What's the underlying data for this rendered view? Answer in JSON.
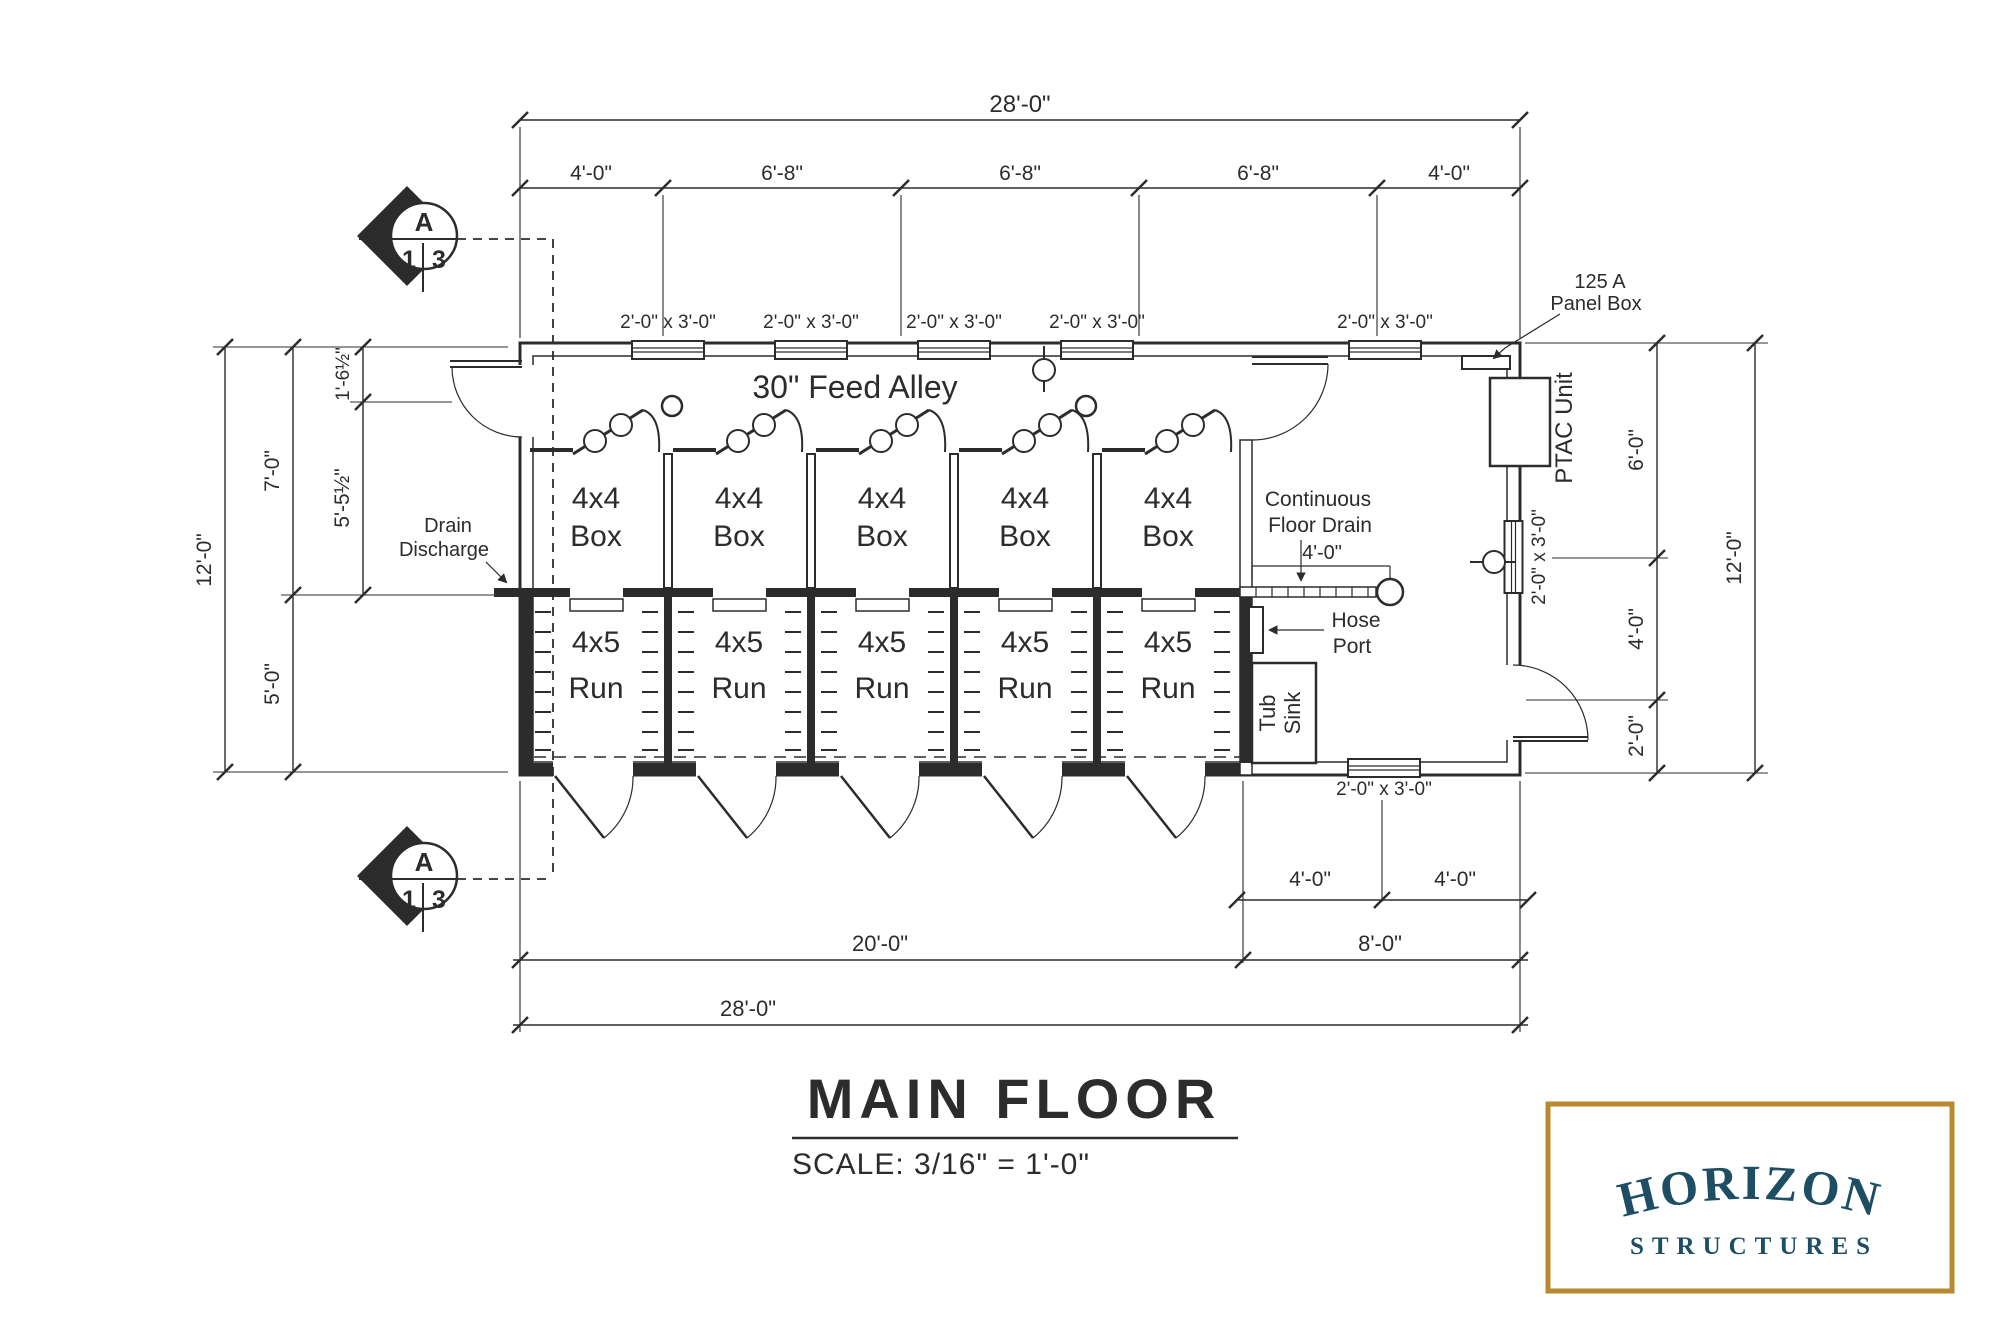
{
  "drawing": {
    "feed_alley": "30\" Feed Alley",
    "stalls": [
      {
        "box1": "4x4",
        "box2": "Box",
        "run1": "4x5",
        "run2": "Run"
      },
      {
        "box1": "4x4",
        "box2": "Box",
        "run1": "4x5",
        "run2": "Run"
      },
      {
        "box1": "4x4",
        "box2": "Box",
        "run1": "4x5",
        "run2": "Run"
      },
      {
        "box1": "4x4",
        "box2": "Box",
        "run1": "4x5",
        "run2": "Run"
      },
      {
        "box1": "4x4",
        "box2": "Box",
        "run1": "4x5",
        "run2": "Run"
      }
    ],
    "annotations": {
      "panel1": "125 A",
      "panel2": "Panel Box",
      "cfd1": "Continuous",
      "cfd2": "Floor Drain",
      "cfd_dim": "4'-0\"",
      "drain1": "Drain",
      "drain2": "Discharge",
      "hose1": "Hose",
      "hose2": "Port",
      "tub1": "Tub",
      "tub2": "Sink",
      "ptac": "PTAC Unit"
    },
    "dims": {
      "window_size": "2'-0\" x 3'-0\"",
      "top_overall": "28'-0\"",
      "top_segments": [
        "4'-0\"",
        "6'-8\"",
        "6'-8\"",
        "6'-8\"",
        "4'-0\""
      ],
      "left_overall": "12'-0\"",
      "left_upper": "7'-0\"",
      "left_lower": "5'-0\"",
      "left_inner_upper": "1'-6½\"",
      "left_inner_lower": "5'-5½\"",
      "right_overall": "12'-0\"",
      "right_a": "6'-0\"",
      "right_b": "4'-0\"",
      "right_c": "2'-0\"",
      "bottom_left": "20'-0\"",
      "bottom_right": "8'-0\"",
      "bottom_overall": "28'-0\"",
      "bottom_r1": "4'-0\"",
      "bottom_r2": "4'-0\""
    },
    "section_marker": {
      "letter": "A",
      "top": "1",
      "bottom": "3"
    },
    "title": "MAIN FLOOR",
    "scale": "SCALE: 3/16\" = 1'-0\""
  },
  "logo": {
    "name": "HORIZON",
    "tagline": "STRUCTURES",
    "text_color": "#1e4e63",
    "border_color": "#b9892f"
  }
}
